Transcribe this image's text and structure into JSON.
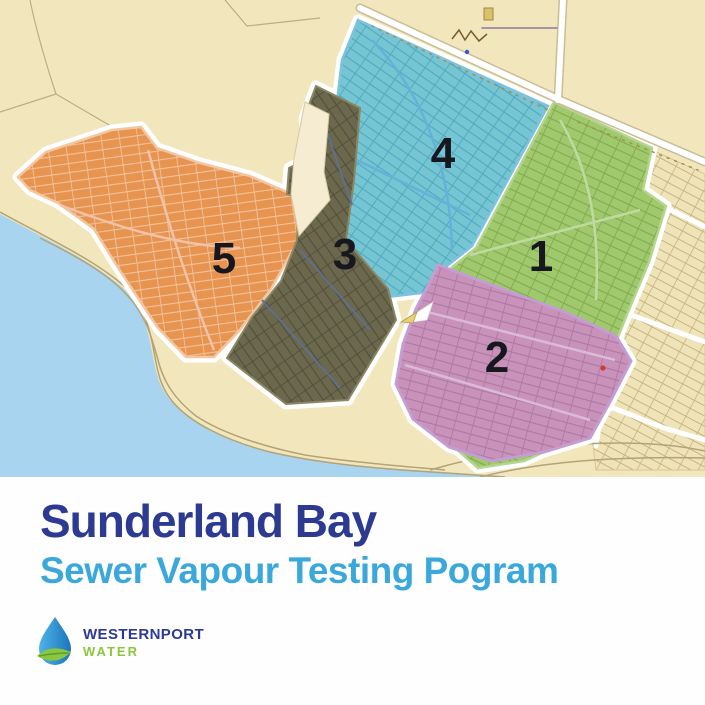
{
  "map": {
    "name": "Sunderland Bay sewer testing zones map",
    "land_color": "#f2e7bc",
    "water_color": "#a9d4ef",
    "zones": [
      {
        "label": "1",
        "color": "#a0c96e",
        "line_color": "#82ab4e"
      },
      {
        "label": "2",
        "color": "#c992ba",
        "line_color": "#ad79a2"
      },
      {
        "label": "3",
        "color": "#6b684d",
        "line_color": "#514f3a"
      },
      {
        "label": "4",
        "color": "#76c5d2",
        "line_color": "#4fa9c0"
      },
      {
        "label": "5",
        "color": "#e6944f",
        "line_color": "#f2c29c"
      }
    ],
    "unzoned_parcel_color": "#efe4b8"
  },
  "footer": {
    "title": "Sunderland Bay",
    "subtitle": "Sewer Vapour Testing Pogram",
    "title_color": "#2c3a92",
    "subtitle_color": "#3ba8dc",
    "logo": {
      "line1": "WESTERNPORT",
      "line2": "WATER",
      "line1_color": "#2c3a92",
      "line2_color": "#8cc63e",
      "drop_blue": "#1b75bb",
      "leaf_green": "#8cc63e"
    }
  }
}
